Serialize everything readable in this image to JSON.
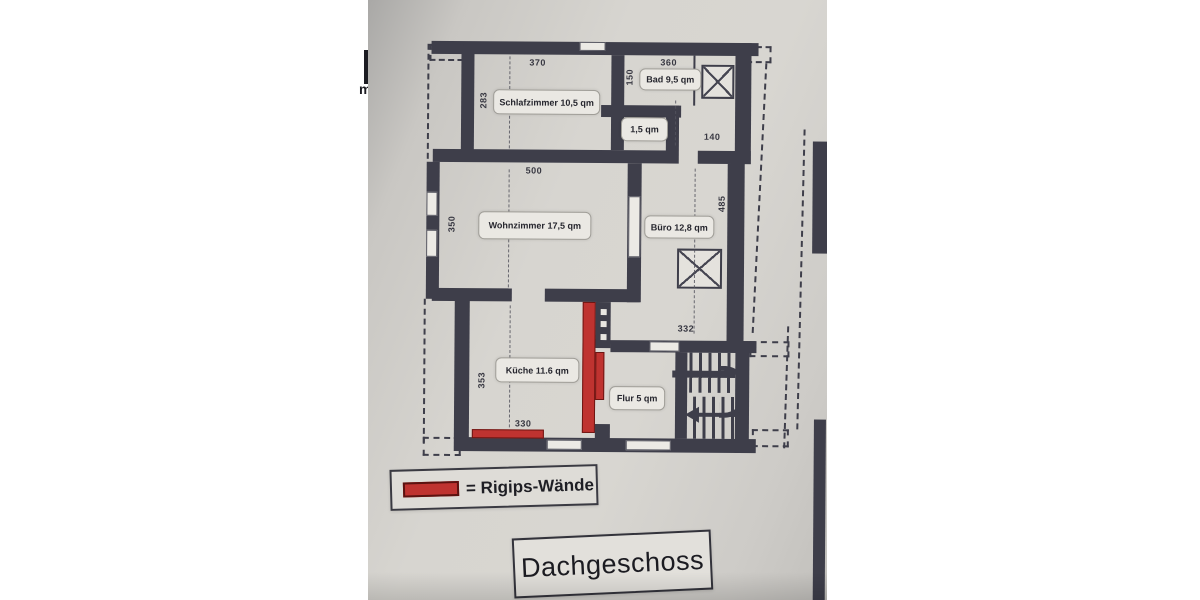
{
  "document": {
    "type": "scanned floor plan photo",
    "floor_title": "Dachgeschoss"
  },
  "plan": {
    "rooms": {
      "schlafzimmer": {
        "label": "Schlafzimmer 10,5 qm"
      },
      "bad": {
        "label": "Bad 9,5 qm"
      },
      "wc": {
        "label": "1,5 qm"
      },
      "wohnzimmer": {
        "label": "Wohnzimmer 17,5 qm"
      },
      "buero": {
        "label": "Büro 12,8 qm"
      },
      "kueche": {
        "label": "Küche 11.6 qm"
      },
      "flur": {
        "label": "Flur 5 qm"
      }
    },
    "dims": {
      "d370": "370",
      "d360": "360",
      "d283": "283",
      "d150": "150",
      "d140": "140",
      "d500": "500",
      "d350": "350",
      "d485": "485",
      "d332": "332",
      "d353": "353",
      "d330": "330"
    }
  },
  "legend": {
    "label": "= Rigips-Wände"
  },
  "title": {
    "label": "Dachgeschoss"
  },
  "fragments": {
    "left_text": "m"
  },
  "colors": {
    "wall": "#3e3e4a",
    "rigips": "#bf3330",
    "paper": "#d6d4cf",
    "page": "#ffffff"
  }
}
